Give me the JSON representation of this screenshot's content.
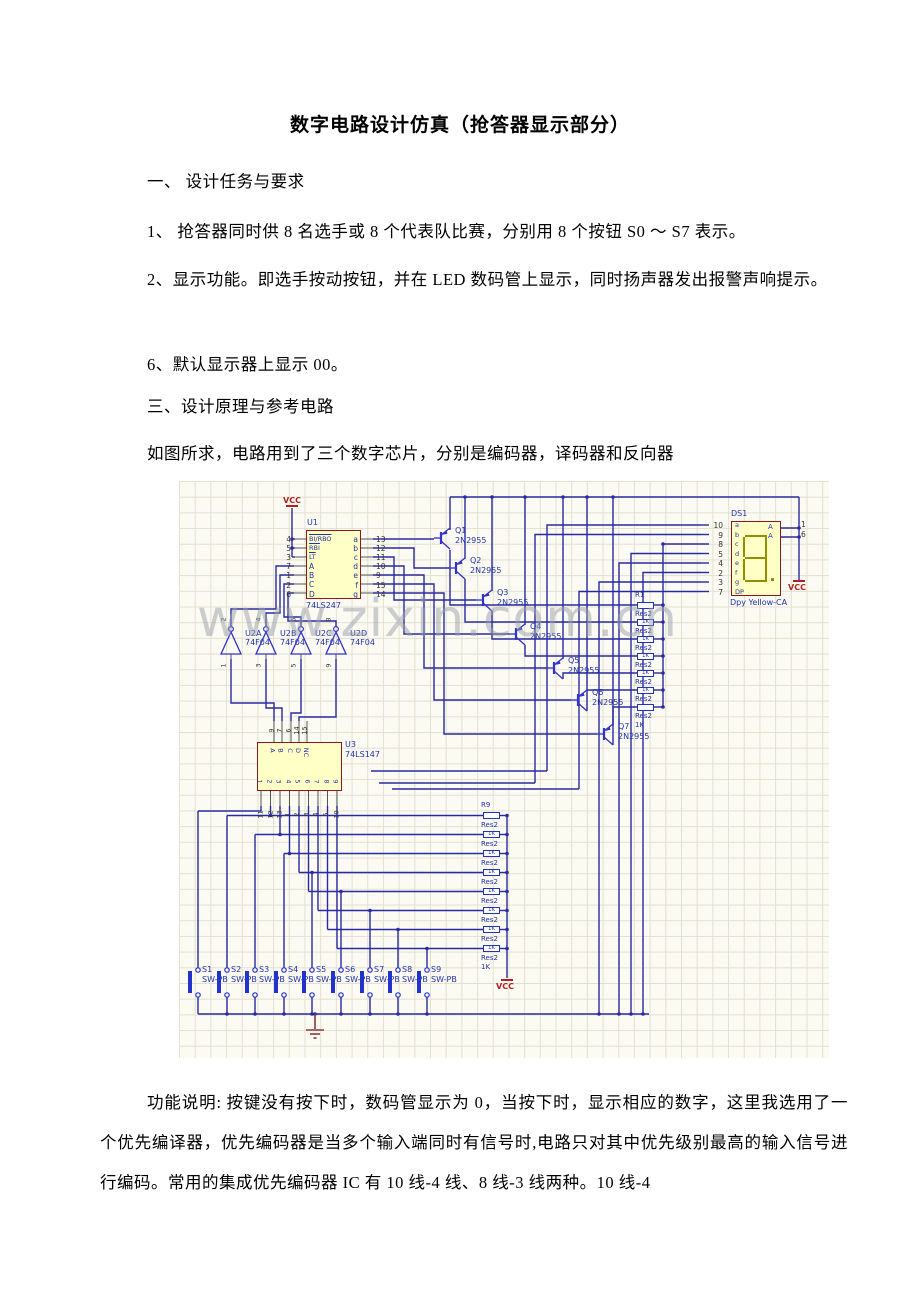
{
  "document": {
    "title": "数字电路设计仿真（抢答器显示部分）",
    "p1": "一、 设计任务与要求",
    "p2": "1、 抢答器同时供 8 名选手或 8 个代表队比赛，分别用 8 个按钮 S0 ～ S7 表示。",
    "p3": "2、显示功能。即选手按动按钮，并在 LED 数码管上显示，同时扬声器发出报警声响提示。",
    "p4": "6、默认显示器上显示 00。",
    "p5": "三、设计原理与参考电路",
    "p6": "如图所求，电路用到了三个数字芯片，分别是编码器，译码器和反向器",
    "p7": "功能说明: 按键没有按下时，数码管显示为 0，当按下时，显示相应的数字，这里我选用了一个优先编译器，优先编码器是当多个输入端同时有信号时,电路只对其中优先级别最高的输入信号进行编码。常用的集成优先编码器 IC 有 10 线-4 线、8 线-3 线两种。10 线-4"
  },
  "schematic": {
    "watermark": "www.zixin.com.cn",
    "vcc": "VCC",
    "u1": {
      "ref": "U1",
      "part": "74LS247",
      "left_nums": "4\n5\n3\n7\n1\n2\n6",
      "ctrl": "BI/RBO\nRBI\nLT",
      "data": "A\nB\nC\nD",
      "out": "a\nb\nc\nd\ne\nf\ng",
      "right_nums": "13\n12\n11\n10\n9\n15\n14"
    },
    "u2": {
      "gates": [
        {
          "ref": "U2A",
          "part": "74F04",
          "top": "2",
          "bot": "1"
        },
        {
          "ref": "U2B",
          "part": "74F04",
          "top": "4",
          "bot": "3"
        },
        {
          "ref": "U2C",
          "part": "74F04",
          "top": "6",
          "bot": "5"
        },
        {
          "ref": "U2D",
          "part": "74F04",
          "top": "8",
          "bot": "9"
        }
      ]
    },
    "u3": {
      "ref": "U3",
      "part": "74LS147",
      "top_nums": [
        "9",
        "7",
        "6",
        "14",
        "15"
      ],
      "top_labels": [
        "A",
        "B",
        "C",
        "D",
        "NC"
      ],
      "bot_labels": [
        "1",
        "2",
        "3",
        "4",
        "5",
        "6",
        "7",
        "8",
        "9"
      ],
      "bot_nums": [
        "11",
        "12",
        "13",
        "1",
        "2",
        "3",
        "4",
        "5",
        "10"
      ]
    },
    "ds1": {
      "ref": "DS1",
      "part": "Dpy Yellow-CA",
      "left_nums": "10\n9\n8\n5\n4\n2\n3\n7",
      "segs": "a\nb\nc\nd\ne\nf\ng\nDP",
      "anodes": "A\nA",
      "right_nums": "1\n6"
    },
    "q": [
      {
        "ref": "Q1",
        "part": "2N2955"
      },
      {
        "ref": "Q2",
        "part": "2N2955"
      },
      {
        "ref": "Q3",
        "part": "2N2955"
      },
      {
        "ref": "Q4",
        "part": "2N2955"
      },
      {
        "ref": "Q5",
        "part": "2N2955"
      },
      {
        "ref": "Q6",
        "part": "2N2955"
      },
      {
        "ref": "Q7",
        "part": "2N2955"
      }
    ],
    "r1": {
      "ref": "R1",
      "name": "Res2",
      "value": "1K"
    },
    "r9": {
      "ref": "R9",
      "name": "Res2",
      "value": "1K"
    },
    "s": [
      {
        "ref": "S1",
        "part": "SW-PB"
      },
      {
        "ref": "S2",
        "part": "SW-PB"
      },
      {
        "ref": "S3",
        "part": "SW-PB"
      },
      {
        "ref": "S4",
        "part": "SW-PB"
      },
      {
        "ref": "S5",
        "part": "SW-PB"
      },
      {
        "ref": "S6",
        "part": "SW-PB"
      },
      {
        "ref": "S7",
        "part": "SW-PB"
      },
      {
        "ref": "S8",
        "part": "SW-PB"
      },
      {
        "ref": "S9",
        "part": "SW-PB"
      }
    ]
  }
}
